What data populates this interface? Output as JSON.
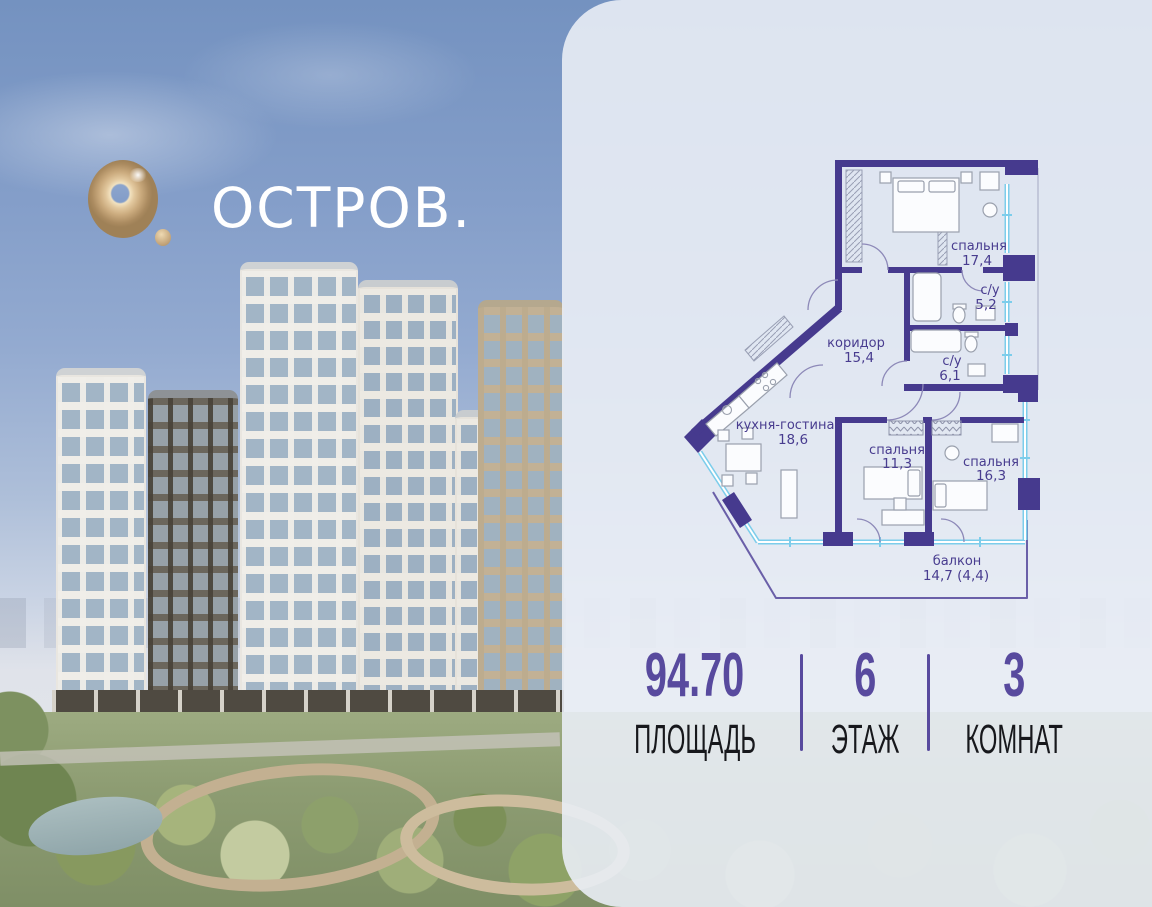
{
  "brand": {
    "name": "ОСТРОВ."
  },
  "floorplan": {
    "rooms": [
      {
        "name": "спальня",
        "area": "17,4"
      },
      {
        "name": "с/у",
        "area": "5,2"
      },
      {
        "name": "коридор",
        "area": "15,4"
      },
      {
        "name": "с/у",
        "area": "6,1"
      },
      {
        "name": "кухня-гостиная",
        "area": "18,6"
      },
      {
        "name": "спальня",
        "area": "11,3"
      },
      {
        "name": "спальня",
        "area": "16,3"
      },
      {
        "name": "балкон",
        "area": "14,7 (4,4)"
      }
    ]
  },
  "stats": [
    {
      "value": "94.70",
      "label": "ПЛОЩАДЬ"
    },
    {
      "value": "6",
      "label": "ЭТАЖ"
    },
    {
      "value": "3",
      "label": "КОМНАТ"
    }
  ],
  "colors": {
    "accent_purple": "#584a9e",
    "plan_wall": "#463a8e",
    "plan_window": "#7ccdeb",
    "logo_gold": "#cbab7e",
    "panel": "#e9edf5",
    "sky_top": "#7492c0"
  }
}
